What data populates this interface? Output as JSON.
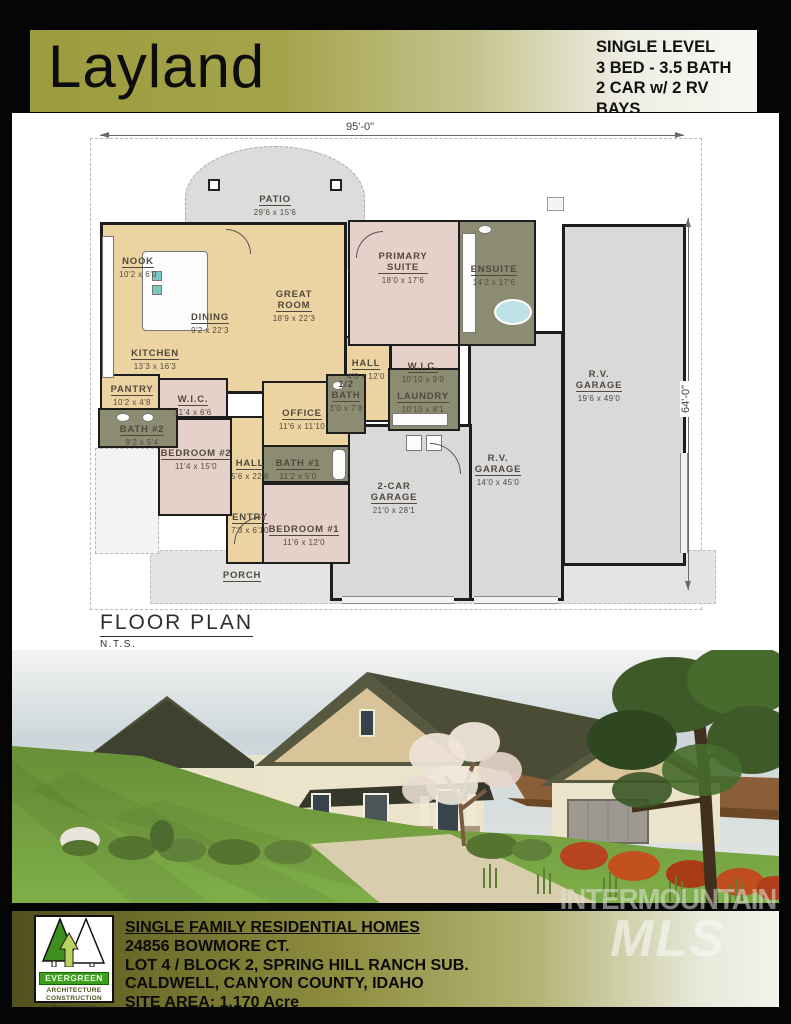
{
  "header": {
    "title": "Layland",
    "specs": [
      "SINGLE LEVEL",
      "3 BED - 3.5 BATH",
      "2 CAR w/ 2 RV BAYS",
      "2,921 S.F."
    ]
  },
  "plan": {
    "caption": "FLOOR PLAN",
    "caption_sub": "N.T.S.",
    "width_dim": "95'-0\"",
    "height_dim": "64'-0\"",
    "rooms": [
      {
        "name": "PATIO",
        "dims": "29'6 x 15'6"
      },
      {
        "name": "NOOK",
        "dims": "10'2 x 6'0"
      },
      {
        "name": "DINING",
        "dims": "9'2 x 22'3"
      },
      {
        "name": "GREAT\nROOM",
        "dims": "18'9 x 22'3"
      },
      {
        "name": "KITCHEN",
        "dims": "13'3 x 16'3"
      },
      {
        "name": "PANTRY",
        "dims": "10'2 x 4'8"
      },
      {
        "name": "PRIMARY\nSUITE",
        "dims": "18'0 x 17'6"
      },
      {
        "name": "ENSUITE",
        "dims": "14'2 x 17'6"
      },
      {
        "name": "W.I.C.",
        "dims": "10'10 x 9'0"
      },
      {
        "name": "HALL",
        "dims": "4'0 x 12'0"
      },
      {
        "name": "LAUNDRY",
        "dims": "10'10 x 8'1"
      },
      {
        "name": "1/2\nBATH",
        "dims": "3'0 x 7'8"
      },
      {
        "name": "OFFICE",
        "dims": "11'6 x 11'10"
      },
      {
        "name": "BATH #1",
        "dims": "11'2 x 5'0"
      },
      {
        "name": "BEDROOM #1",
        "dims": "11'6 x 12'0"
      },
      {
        "name": "HALL",
        "dims": "5'6 x 22'6"
      },
      {
        "name": "ENTRY",
        "dims": "7'3 x 6'10"
      },
      {
        "name": "BEDROOM #2",
        "dims": "11'4 x 15'0"
      },
      {
        "name": "W.I.C.",
        "dims": "11'4 x 6'6"
      },
      {
        "name": "BATH #2",
        "dims": "9'2 x 5'4"
      },
      {
        "name": "2-CAR\nGARAGE",
        "dims": "21'0 x 28'1"
      },
      {
        "name": "R.V.\nGARAGE",
        "dims": "14'0 x 45'0"
      },
      {
        "name": "R.V.\nGARAGE",
        "dims": "19'6 x 49'0"
      },
      {
        "name": "PORCH",
        "dims": ""
      }
    ]
  },
  "footer": {
    "lines": [
      "SINGLE FAMILY RESIDENTIAL HOMES",
      "24856 BOWMORE CT.",
      "LOT 4 / BLOCK 2, SPRING HILL RANCH SUB.",
      "CALDWELL, CANYON COUNTY, IDAHO",
      "SITE AREA: 1.170 Acre"
    ],
    "logo": {
      "name": "EVERGREEN",
      "sub1": "ARCHITECTURE",
      "sub2": "CONSTRUCTION",
      "copyright": "© COPYRIGHT 2023-2024 LCL"
    }
  },
  "watermark": {
    "line1": "INTERMOUNTAIN",
    "line2": "MLS"
  },
  "colors": {
    "brand_olive": "#9c9b3e",
    "plan_living": "#ecd3a2",
    "plan_bedroom": "#e6d0ca",
    "plan_bath": "#8c8c73",
    "plan_garage": "#d9d9d9",
    "logo_green": "#3e9e1e",
    "roof": "#54563c"
  }
}
